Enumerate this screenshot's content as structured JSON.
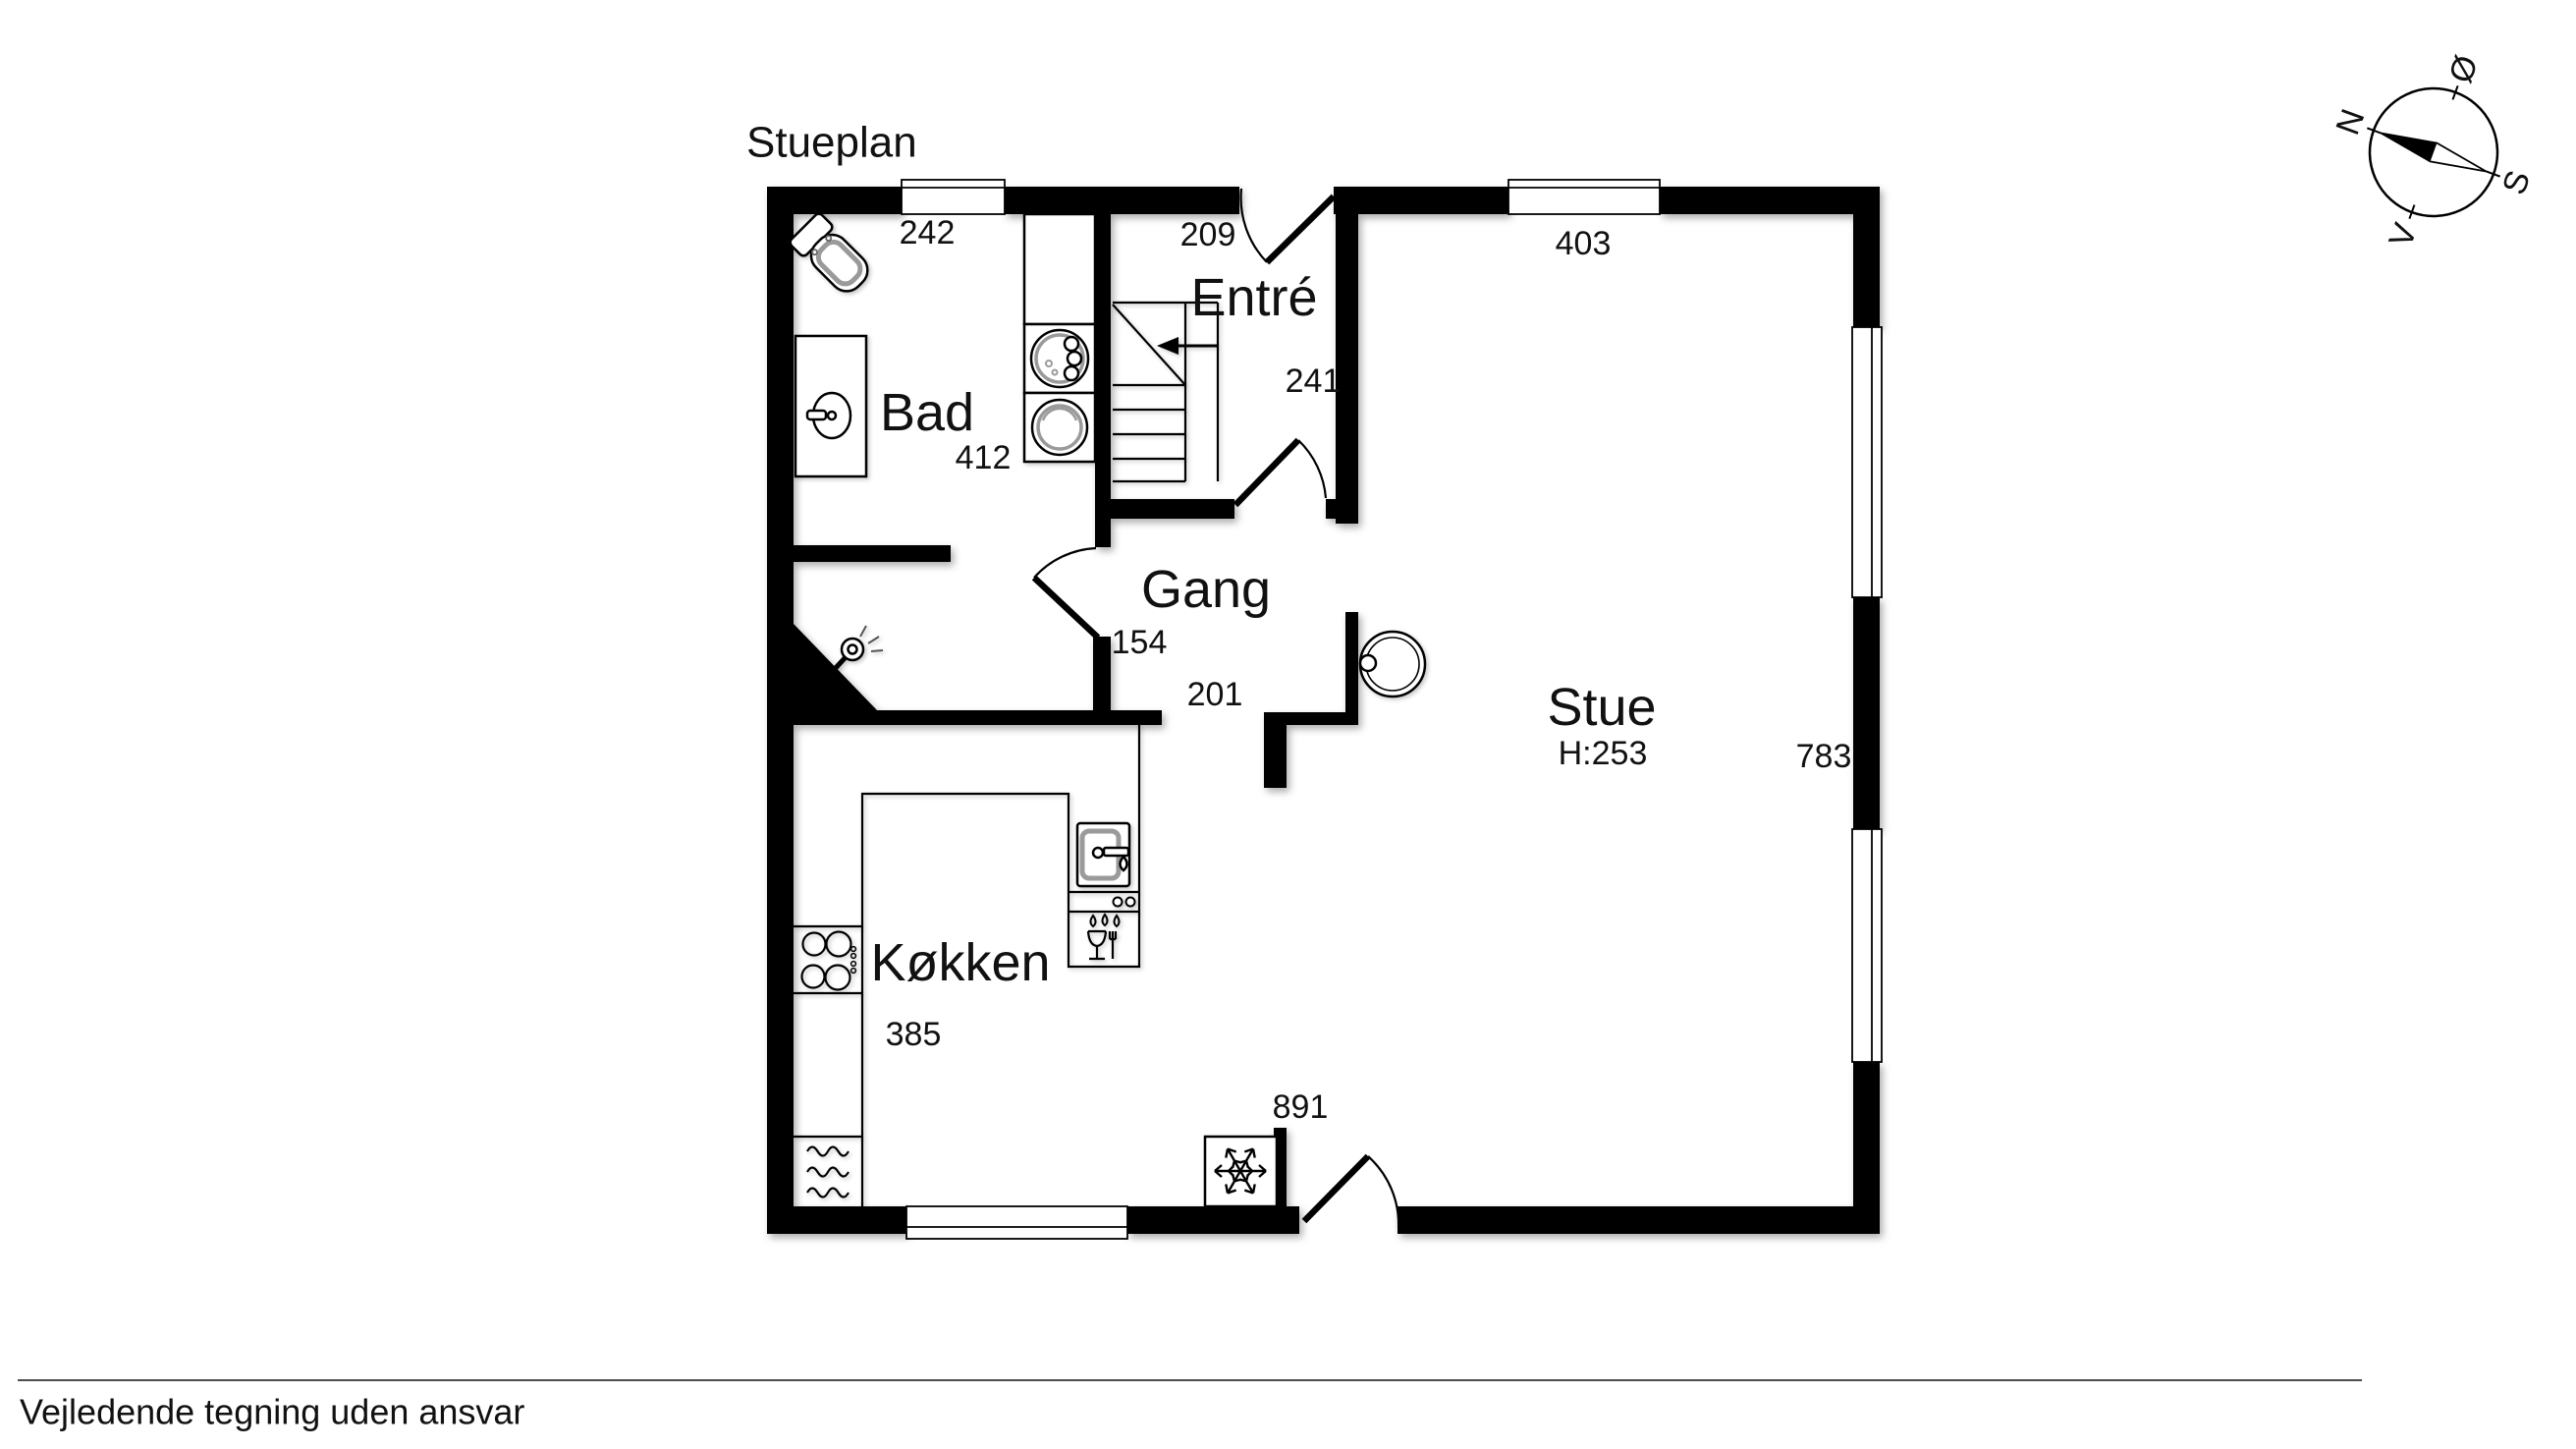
{
  "page": {
    "title": "Stueplan",
    "disclaimer": "Vejledende tegning uden ansvar"
  },
  "rooms": {
    "bad": {
      "label": "Bad",
      "width_cm": "412",
      "window_cm": "242",
      "door_cm": "154"
    },
    "entre": {
      "label": "Entré",
      "width_cm": "241",
      "door_cm": "209"
    },
    "gang": {
      "label": "Gang",
      "opening_cm": "201"
    },
    "stue": {
      "label": "Stue",
      "ceiling_height": "H:253",
      "window_cm": "403",
      "depth_cm": "783",
      "door_cm": "891"
    },
    "kokken": {
      "label": "Køkken",
      "width_cm": "385"
    }
  },
  "compass": {
    "north": "N",
    "east": "Ø",
    "south": "S",
    "west": "V"
  },
  "fixtures": [
    "toilet",
    "washbasin",
    "tall-cabinet",
    "washing-machine",
    "tumble-dryer",
    "staircase-with-up-arrow",
    "ceiling-lamp",
    "wood-stove",
    "kitchen-counter",
    "cooktop",
    "oven",
    "kitchen-sink",
    "dishwasher",
    "freezer"
  ],
  "colors": {
    "wall": "#000000",
    "text": "#111111",
    "fixture_detail": "#9a9a9a",
    "background": "#ffffff"
  }
}
